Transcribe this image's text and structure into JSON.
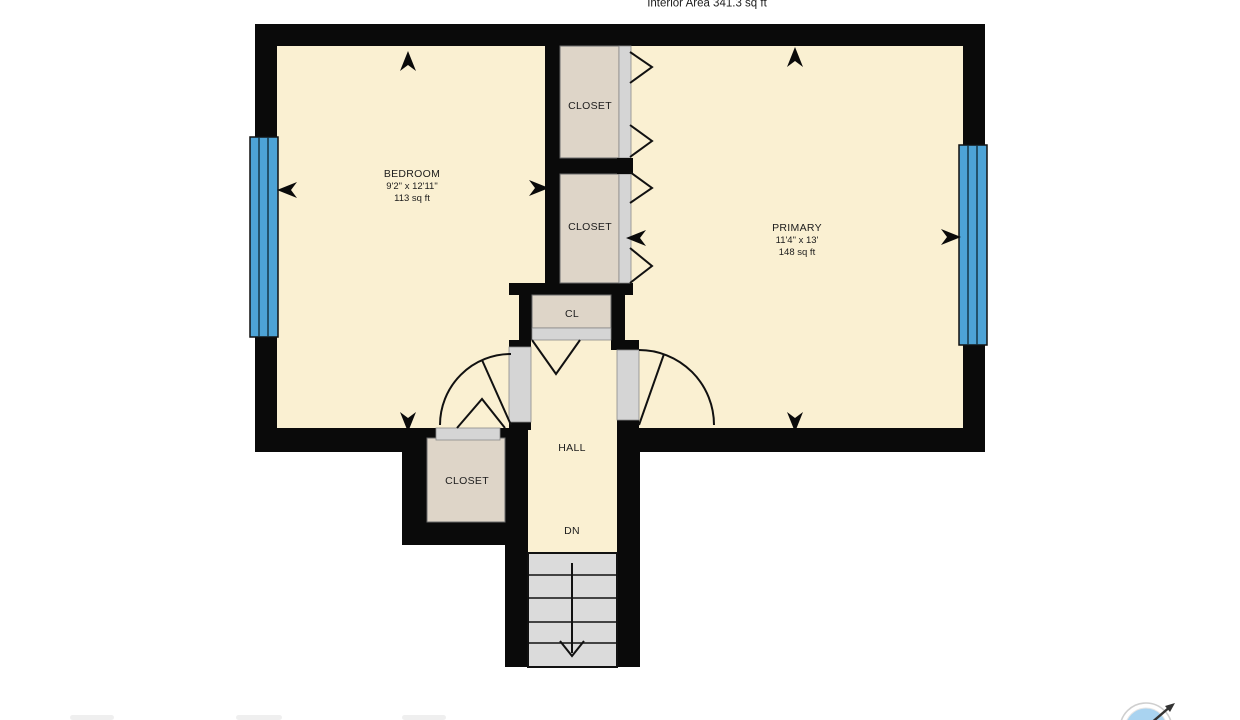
{
  "header": {
    "interior_area": "Interior Area 341.3 sq ft"
  },
  "rooms": {
    "bedroom": {
      "name": "BEDROOM",
      "dimensions": "9'2\" x 12'11\"",
      "area": "113 sq ft"
    },
    "primary": {
      "name": "PRIMARY",
      "dimensions": "11'4\" x 13'",
      "area": "148 sq ft"
    },
    "closet_upper": {
      "name": "CLOSET"
    },
    "closet_lower": {
      "name": "CLOSET"
    },
    "closet_hall": {
      "name": "CL"
    },
    "closet_bedroom": {
      "name": "CLOSET"
    },
    "hall": {
      "name": "HALL"
    },
    "stairs": {
      "direction_label": "DN"
    }
  },
  "colors": {
    "wall": "#0a0a0a",
    "room_floor": "#FAF0D2",
    "closet_floor": "#DED5C8",
    "door_opening": "#D5D5D5",
    "stairs_fill": "#DBDBDB",
    "window_glass": "#4DA3D6",
    "compass_fill": "#A9D3F0"
  },
  "icons": {
    "compass": "compass-logo",
    "stairs_arrow": "down-direction",
    "wall_markers": "entry-direction-arrows"
  }
}
